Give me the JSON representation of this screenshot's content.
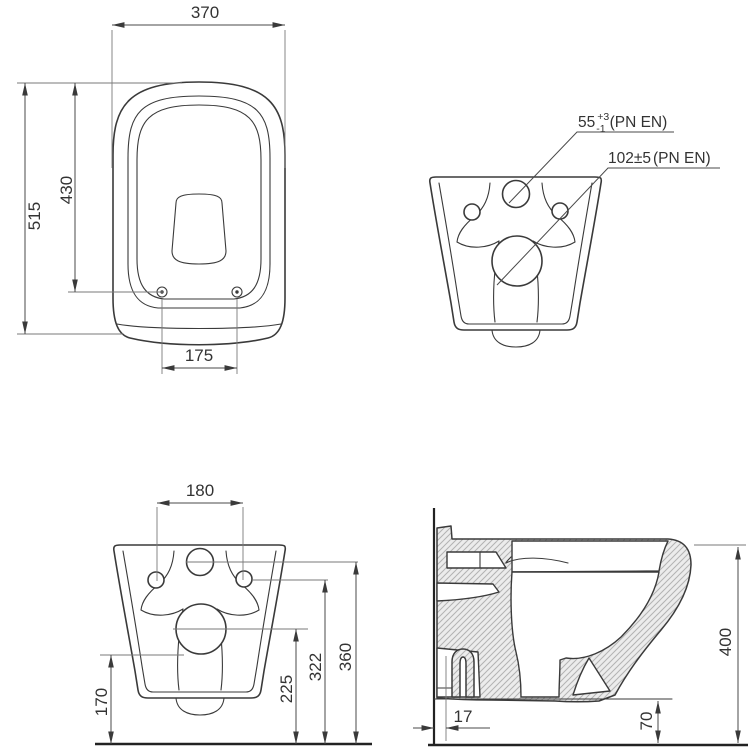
{
  "drawing": {
    "type": "technical-dimensional-drawing",
    "product": "wall-hung toilet",
    "colors": {
      "background": "#ffffff",
      "line": "#3a3a3a",
      "dimension_line": "#4a4a4a",
      "hatch_fill": "#ececec",
      "hatch_line": "#b3b3b3"
    },
    "plan_view": {
      "width": "370",
      "depth": "515",
      "seat_depth": "430",
      "hole_spacing": "175"
    },
    "rear_view": {
      "inlet_value": "55",
      "inlet_tol_plus": "+3",
      "inlet_tol_minus": "-1",
      "inlet_standard": "(PN EN)",
      "outlet_value": "102±5",
      "outlet_standard": "(PN EN)"
    },
    "rear_dim_view": {
      "hole_spacing": "180",
      "outlet_bottom_height": "170",
      "outlet_center_height": "225",
      "holes_height": "322",
      "inlet_height": "360"
    },
    "side_view": {
      "wall_gap": "17",
      "floor_clearance": "70",
      "total_height": "400"
    }
  }
}
